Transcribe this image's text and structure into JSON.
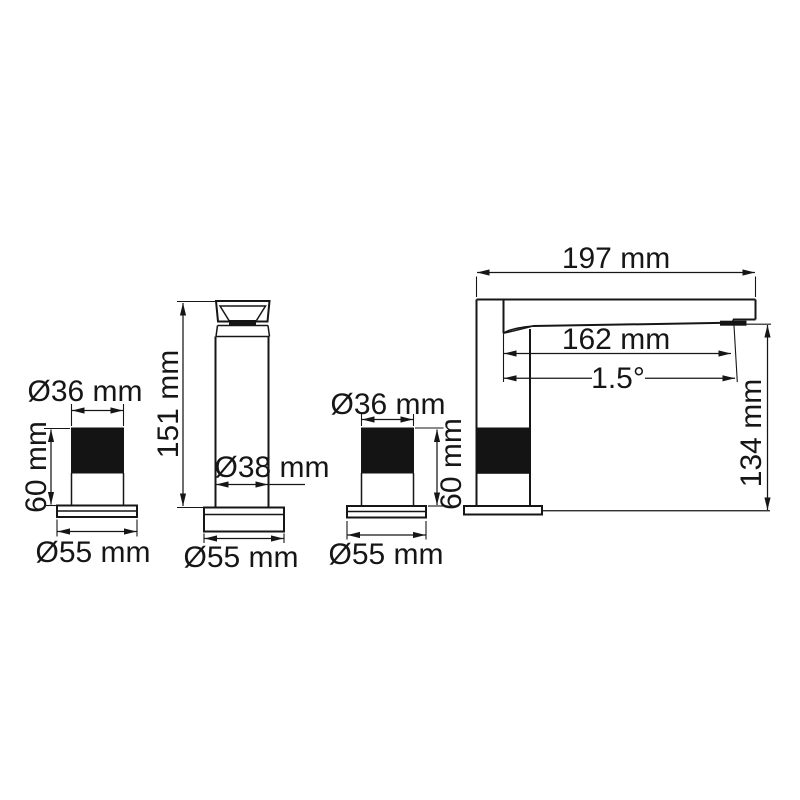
{
  "drawing": {
    "kind": "technical-dimension-drawing",
    "subject": "deck-mounted 3-hole basin mixer: two handles, spout front view, spout side view",
    "background_color": "#ffffff",
    "line_color": "#161616",
    "views": {
      "left_handle_front": {
        "name": "left handle front view",
        "dimensions": {
          "top_diameter": "Ø36 mm",
          "handle_height": "60 mm",
          "base_diameter": "Ø55 mm"
        }
      },
      "spout_front": {
        "name": "spout column front view",
        "dimensions": {
          "total_height": "151 mm",
          "body_diameter": "Ø38 mm",
          "base_diameter": "Ø55 mm"
        }
      },
      "right_handle_front": {
        "name": "right handle front view",
        "dimensions": {
          "top_diameter": "Ø36 mm",
          "handle_height": "60 mm",
          "base_diameter": "Ø55 mm"
        }
      },
      "spout_side": {
        "name": "spout side view",
        "dimensions": {
          "overall_length": "197 mm",
          "spout_reach": "162 mm",
          "spout_angle": "1.5°",
          "spout_height": "134 mm"
        }
      }
    }
  }
}
